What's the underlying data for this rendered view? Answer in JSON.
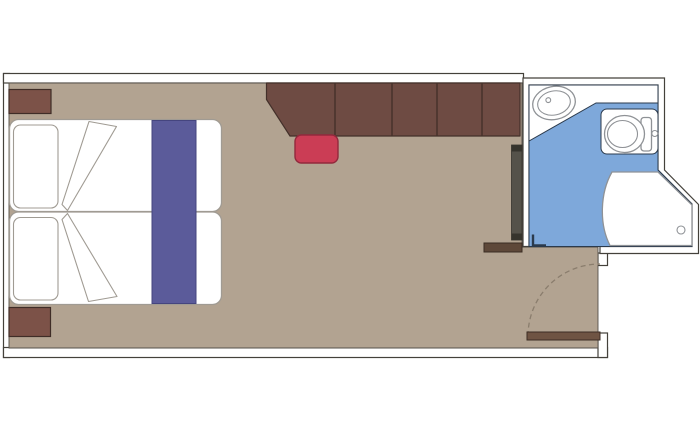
{
  "colors": {
    "page_bg": "#ffffff",
    "wall_fill": "#ffffff",
    "wall_line": "#44413b",
    "floor": "#b2a391",
    "floor_line": "#55504a",
    "wardrobe": "#6e4b43",
    "wardrobe_line": "#43302a",
    "wardrobe_divider": "#4a342d",
    "nightstand": "#7c5248",
    "nightstand_line": "#3f2d27",
    "bed_outline": "#a09b93",
    "runner": "#5b5b9a",
    "runner_line": "#45457f",
    "stool": "#cb3d55",
    "stool_line": "#92293c",
    "mirror": "#55524a",
    "mirror_cap": "#36342d",
    "shelf": "#5e4839",
    "shelf_line": "#3a2c22",
    "door_leaf": "#6f5443",
    "door_leaf_line": "#3c2d24",
    "door_arc": "#8a7d6d",
    "bath_floor": "#7ea8da",
    "bath_line": "#2b3a4c",
    "fixture_line": "#8f9296",
    "fixture_fill": "#ffffff"
  },
  "furniture": {
    "bed": "double-bed",
    "pillows": "pillow",
    "blankets": "folded-blanket",
    "runner": "bed-runner",
    "nightstands": "nightstand",
    "wardrobe": "wardrobe",
    "stool": "stool",
    "mirror": "mirror-panel",
    "shelf": "shelf",
    "entrance": "entrance-door",
    "swing": "door-swing-arc",
    "sink": "bathroom-sink",
    "toilet": "toilet",
    "shower": "shower",
    "bath_door": "bathroom-door-frame"
  }
}
